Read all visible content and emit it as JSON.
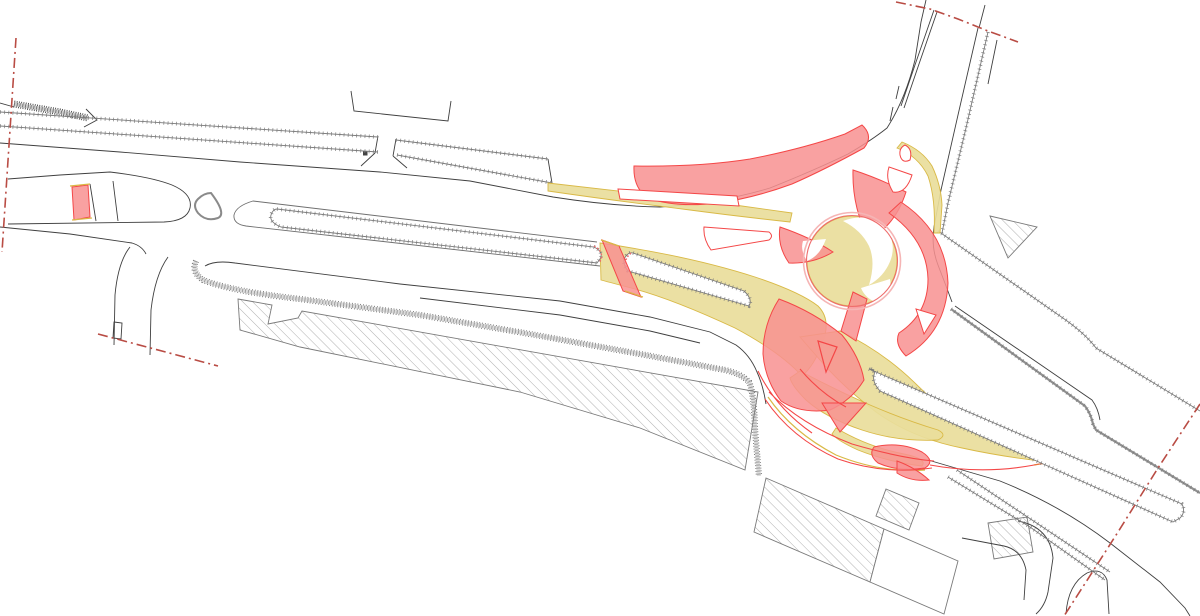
{
  "canvas": {
    "width": 1200,
    "height": 616
  },
  "drawing": {
    "kind": "roundabout-junction-engineering-plan",
    "text_labels": []
  },
  "colors": {
    "background": "#ffffff",
    "roadDark": "#3f3f3f",
    "roadMedium": "#6f6f6f",
    "roadLight": "#8f8f8f",
    "tick": "#7a7a7a",
    "wallLight": "#dcdcdc",
    "wallDark": "#3d3d3d",
    "hatch": "#9c9c9c",
    "buildingOutline": "#7a7a7a",
    "sweptYellowFill": "#e9dd9b",
    "sweptYellowLine": "#d9b946",
    "sweptRedFill": "#f89090",
    "sweptRedLine": "#f44747",
    "ringOuter": "#f5b5b5",
    "ringInner": "#ee6e6e",
    "dottedKerb": "#ee6a6a",
    "boundary": "#b94c44",
    "accentOrange": "#e8763a"
  }
}
